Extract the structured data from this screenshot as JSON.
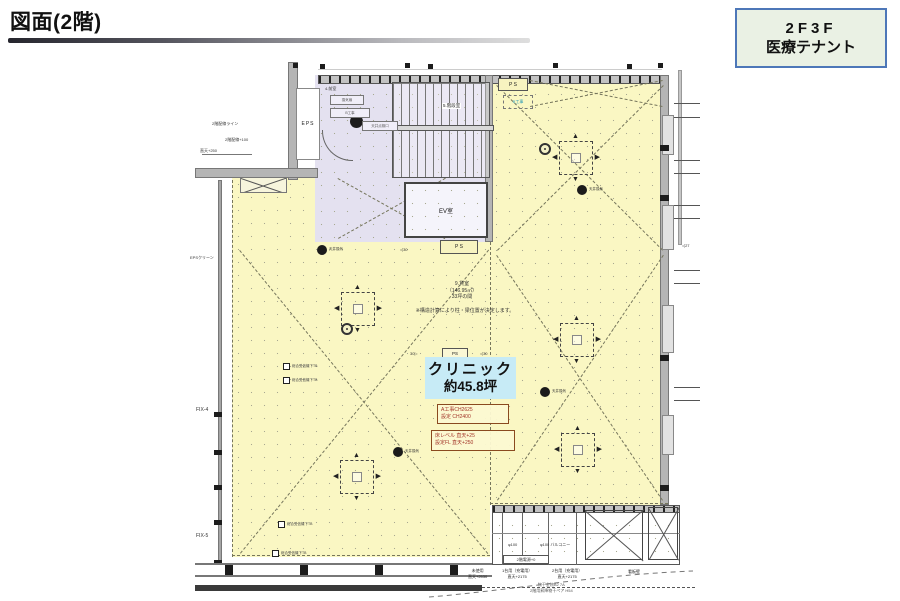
{
  "page": {
    "title": "図面(2階)"
  },
  "badge": {
    "line1": "2F3F",
    "line2": "医療テナント"
  },
  "clinic": {
    "name": "クリニック",
    "area": "約45.8坪"
  },
  "notes": {
    "a_koji_1": "A工事CH2625",
    "a_koji_2": "設定 CH2400",
    "floor_1": "床レベル 直天+25",
    "floor_2": "設定FL 直天+250",
    "area_1": "9.貸室",
    "area_2": "（146.95㎡）",
    "area_3": "33坪の間",
    "structure": "※構造計算により柱・梁位置が決定します。"
  },
  "rooms": {
    "eps": "EPS",
    "ev": "EV室",
    "stair": "5.階段室",
    "ps": "P S",
    "ps2": "P S",
    "ps3": "PS",
    "eps_clean": "EPSクリーン"
  },
  "core_labels": {
    "c1": "換気扇",
    "c2": "B工事",
    "c3": "天井点検口",
    "c4": "4.前室"
  },
  "windows": {
    "fix4": "FIX-4",
    "fix5": "FIX-5"
  },
  "left_annotations": {
    "l1": "2階配線ライン",
    "l2": "2階配線+100",
    "l3": "直天+250"
  },
  "equipment": {
    "vent": "天井換気",
    "receiver": "総合受信機下TB",
    "b_koji": "B工事"
  },
  "dims": {
    "d30a": "◁30",
    "d30b": "30▷",
    "d27": "◁27"
  },
  "bottom": {
    "power": "2階電源+0",
    "phi100": "φ100",
    "phi100b": "φ100 バルコニー",
    "unused1": "未使用",
    "unused2": "直天+2530",
    "car1a": "1台用（充電用）",
    "car1b": "直天+2175",
    "car2a": "2台用（充電用）",
    "car2b": "直天+2175",
    "sign": "看板壁",
    "laundry1": "物干金物B2 7A",
    "laundry2": "2階用昇降物干ペア H54"
  }
}
